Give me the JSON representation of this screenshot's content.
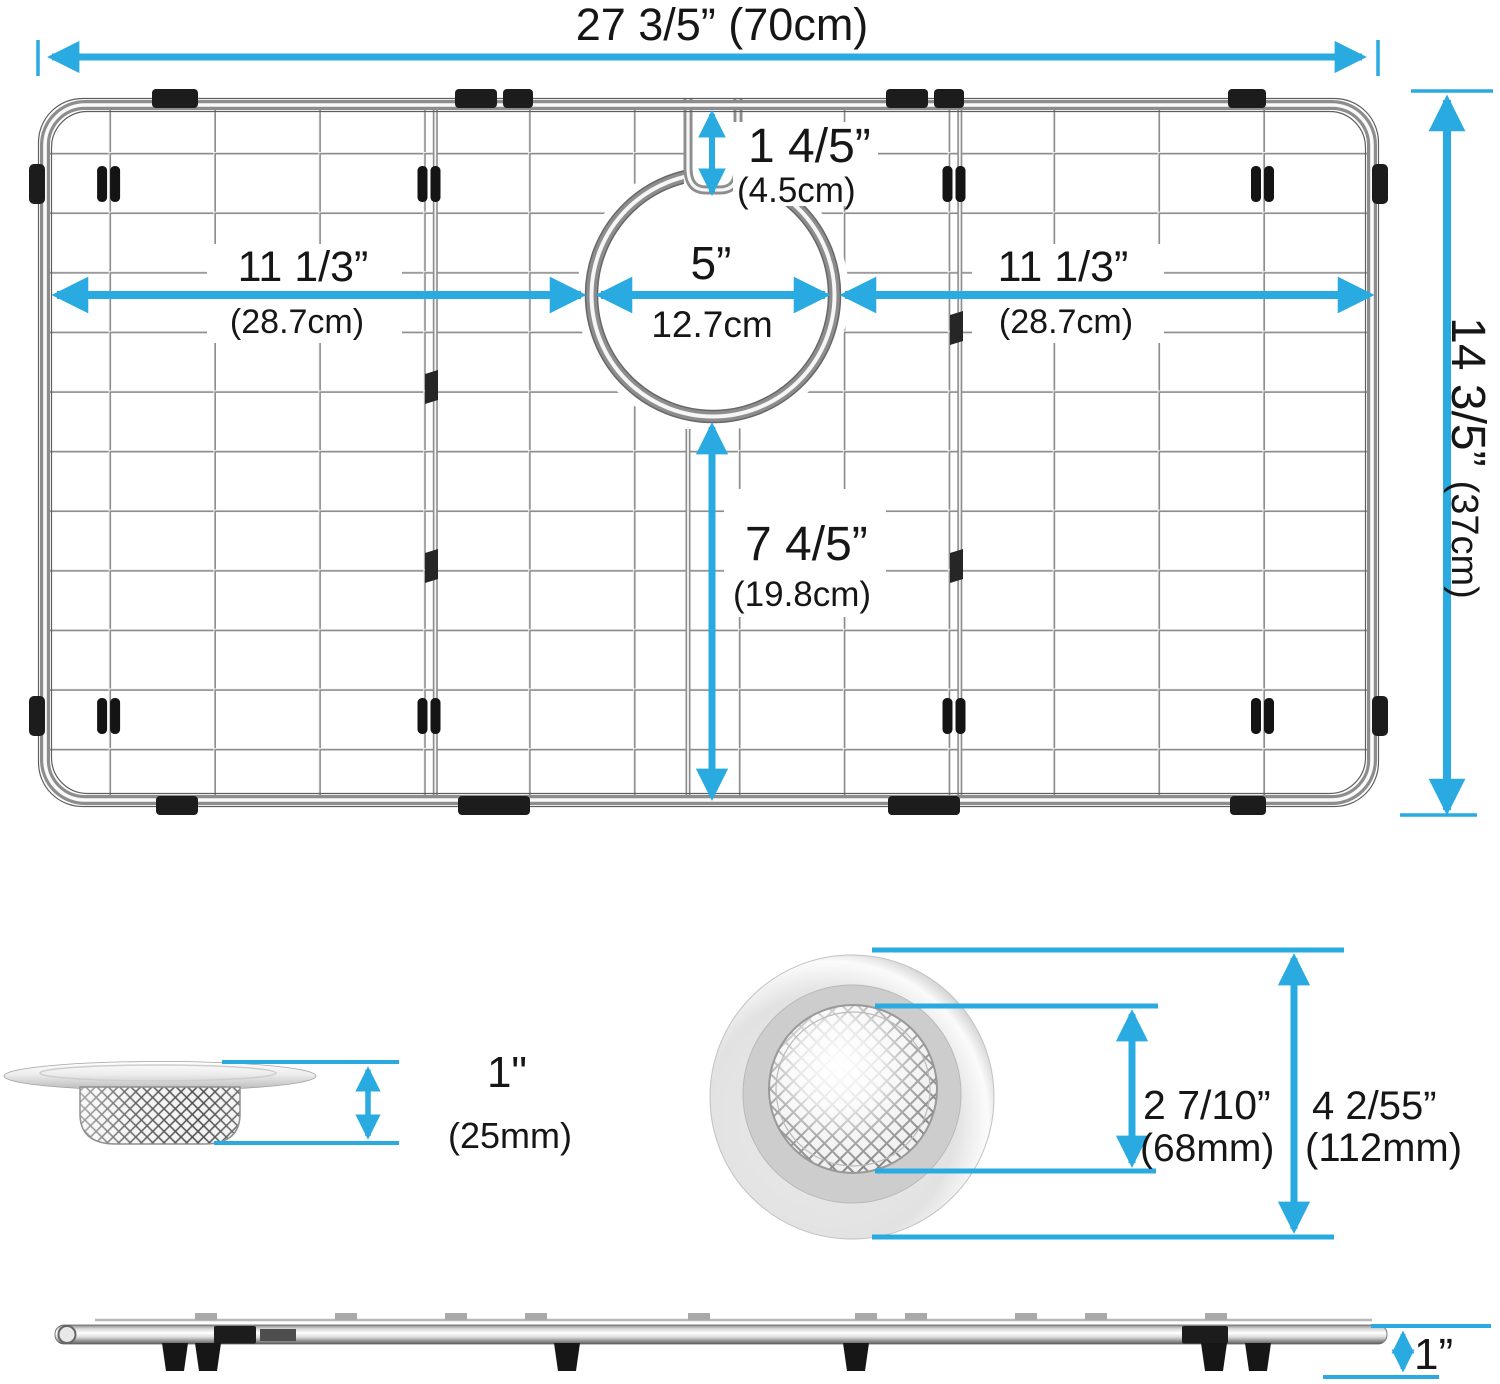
{
  "colors": {
    "accent": "#29ABE2",
    "wire": "#8d8d8d",
    "bumper_black": "#1c1c1c"
  },
  "top_view": {
    "overall_width": "27 3/5” (70cm)",
    "notch_in": "1 4/5”",
    "notch_cm": "(4.5cm)",
    "left_in": "11 1/3”",
    "left_cm": "(28.7cm)",
    "drain_in": "5”",
    "drain_cm": "12.7cm",
    "right_in": "11 1/3”",
    "right_cm": "(28.7cm)",
    "height_in": "14 3/5”",
    "height_cm": "(37cm)",
    "below_in": "7 4/5”",
    "below_cm": "(19.8cm)"
  },
  "strainer_side": {
    "in": "1\"",
    "mm": "(25mm)"
  },
  "strainer_top": {
    "inner_in": "2 7/10”",
    "inner_mm": "(68mm)",
    "outer_in": "4 2/55”",
    "outer_mm": "(112mm)"
  },
  "grid_side": {
    "in": "1”"
  }
}
